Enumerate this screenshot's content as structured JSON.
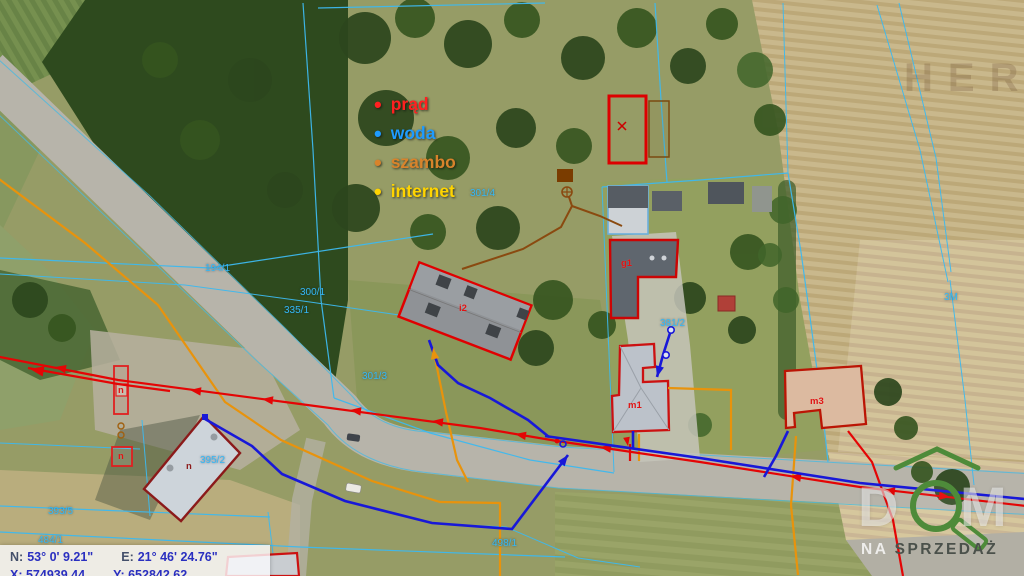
{
  "map": {
    "legend": {
      "items": [
        {
          "label": "prąd",
          "color": "#ff2020"
        },
        {
          "label": "woda",
          "color": "#1e9bff"
        },
        {
          "label": "szambo",
          "color": "#d8832b"
        },
        {
          "label": "internet",
          "color": "#ffd400"
        }
      ]
    },
    "coordinates": {
      "n_label": "N:",
      "n_value": "53° 0' 9.21\"",
      "e_label": "E:",
      "e_value": "21° 46' 24.76\"",
      "x_partial": "X: 574939.44",
      "y_partial": "Y: 652842.62"
    },
    "watermark": "HERS",
    "logo": {
      "letter_d": "D",
      "letter_m": "M",
      "tag_light": "NA",
      "tag_dark": "SPRZEDAŻ",
      "green": "#4e8b3a"
    },
    "parcel_labels": [
      {
        "label": "301/4",
        "x": 470,
        "y": 188
      },
      {
        "label": "194/1",
        "x": 205,
        "y": 263
      },
      {
        "label": "300/1",
        "x": 300,
        "y": 287
      },
      {
        "label": "335/1",
        "x": 284,
        "y": 305
      },
      {
        "label": "301/3",
        "x": 362,
        "y": 371
      },
      {
        "label": "381/2",
        "x": 660,
        "y": 318
      },
      {
        "label": "395/2",
        "x": 200,
        "y": 455
      },
      {
        "label": "393/5",
        "x": 48,
        "y": 506
      },
      {
        "label": "484/1",
        "x": 38,
        "y": 535
      },
      {
        "label": "498/1",
        "x": 492,
        "y": 538
      },
      {
        "label": "3M",
        "x": 944,
        "y": 292
      }
    ],
    "building_labels": [
      {
        "label": "i2",
        "x": 459,
        "y": 303,
        "color": "#e01414"
      },
      {
        "label": "g1",
        "x": 621,
        "y": 258,
        "color": "#e01414"
      },
      {
        "label": "m1",
        "x": 628,
        "y": 400,
        "color": "#e01414"
      },
      {
        "label": "m3",
        "x": 810,
        "y": 396,
        "color": "#e01414"
      },
      {
        "label": "n",
        "x": 118,
        "y": 385,
        "color": "#e01414"
      },
      {
        "label": "n",
        "x": 118,
        "y": 451,
        "color": "#e01414"
      },
      {
        "label": "n",
        "x": 186,
        "y": 461,
        "color": "#8b1a1a"
      }
    ],
    "utility_colors": {
      "prad": "#e40505",
      "woda": "#1818d8",
      "szambo": "#e8930c",
      "szambo_symbol": "#7a3c00",
      "internet": "#ffd400",
      "parcel_line": "#3db9ef"
    }
  }
}
